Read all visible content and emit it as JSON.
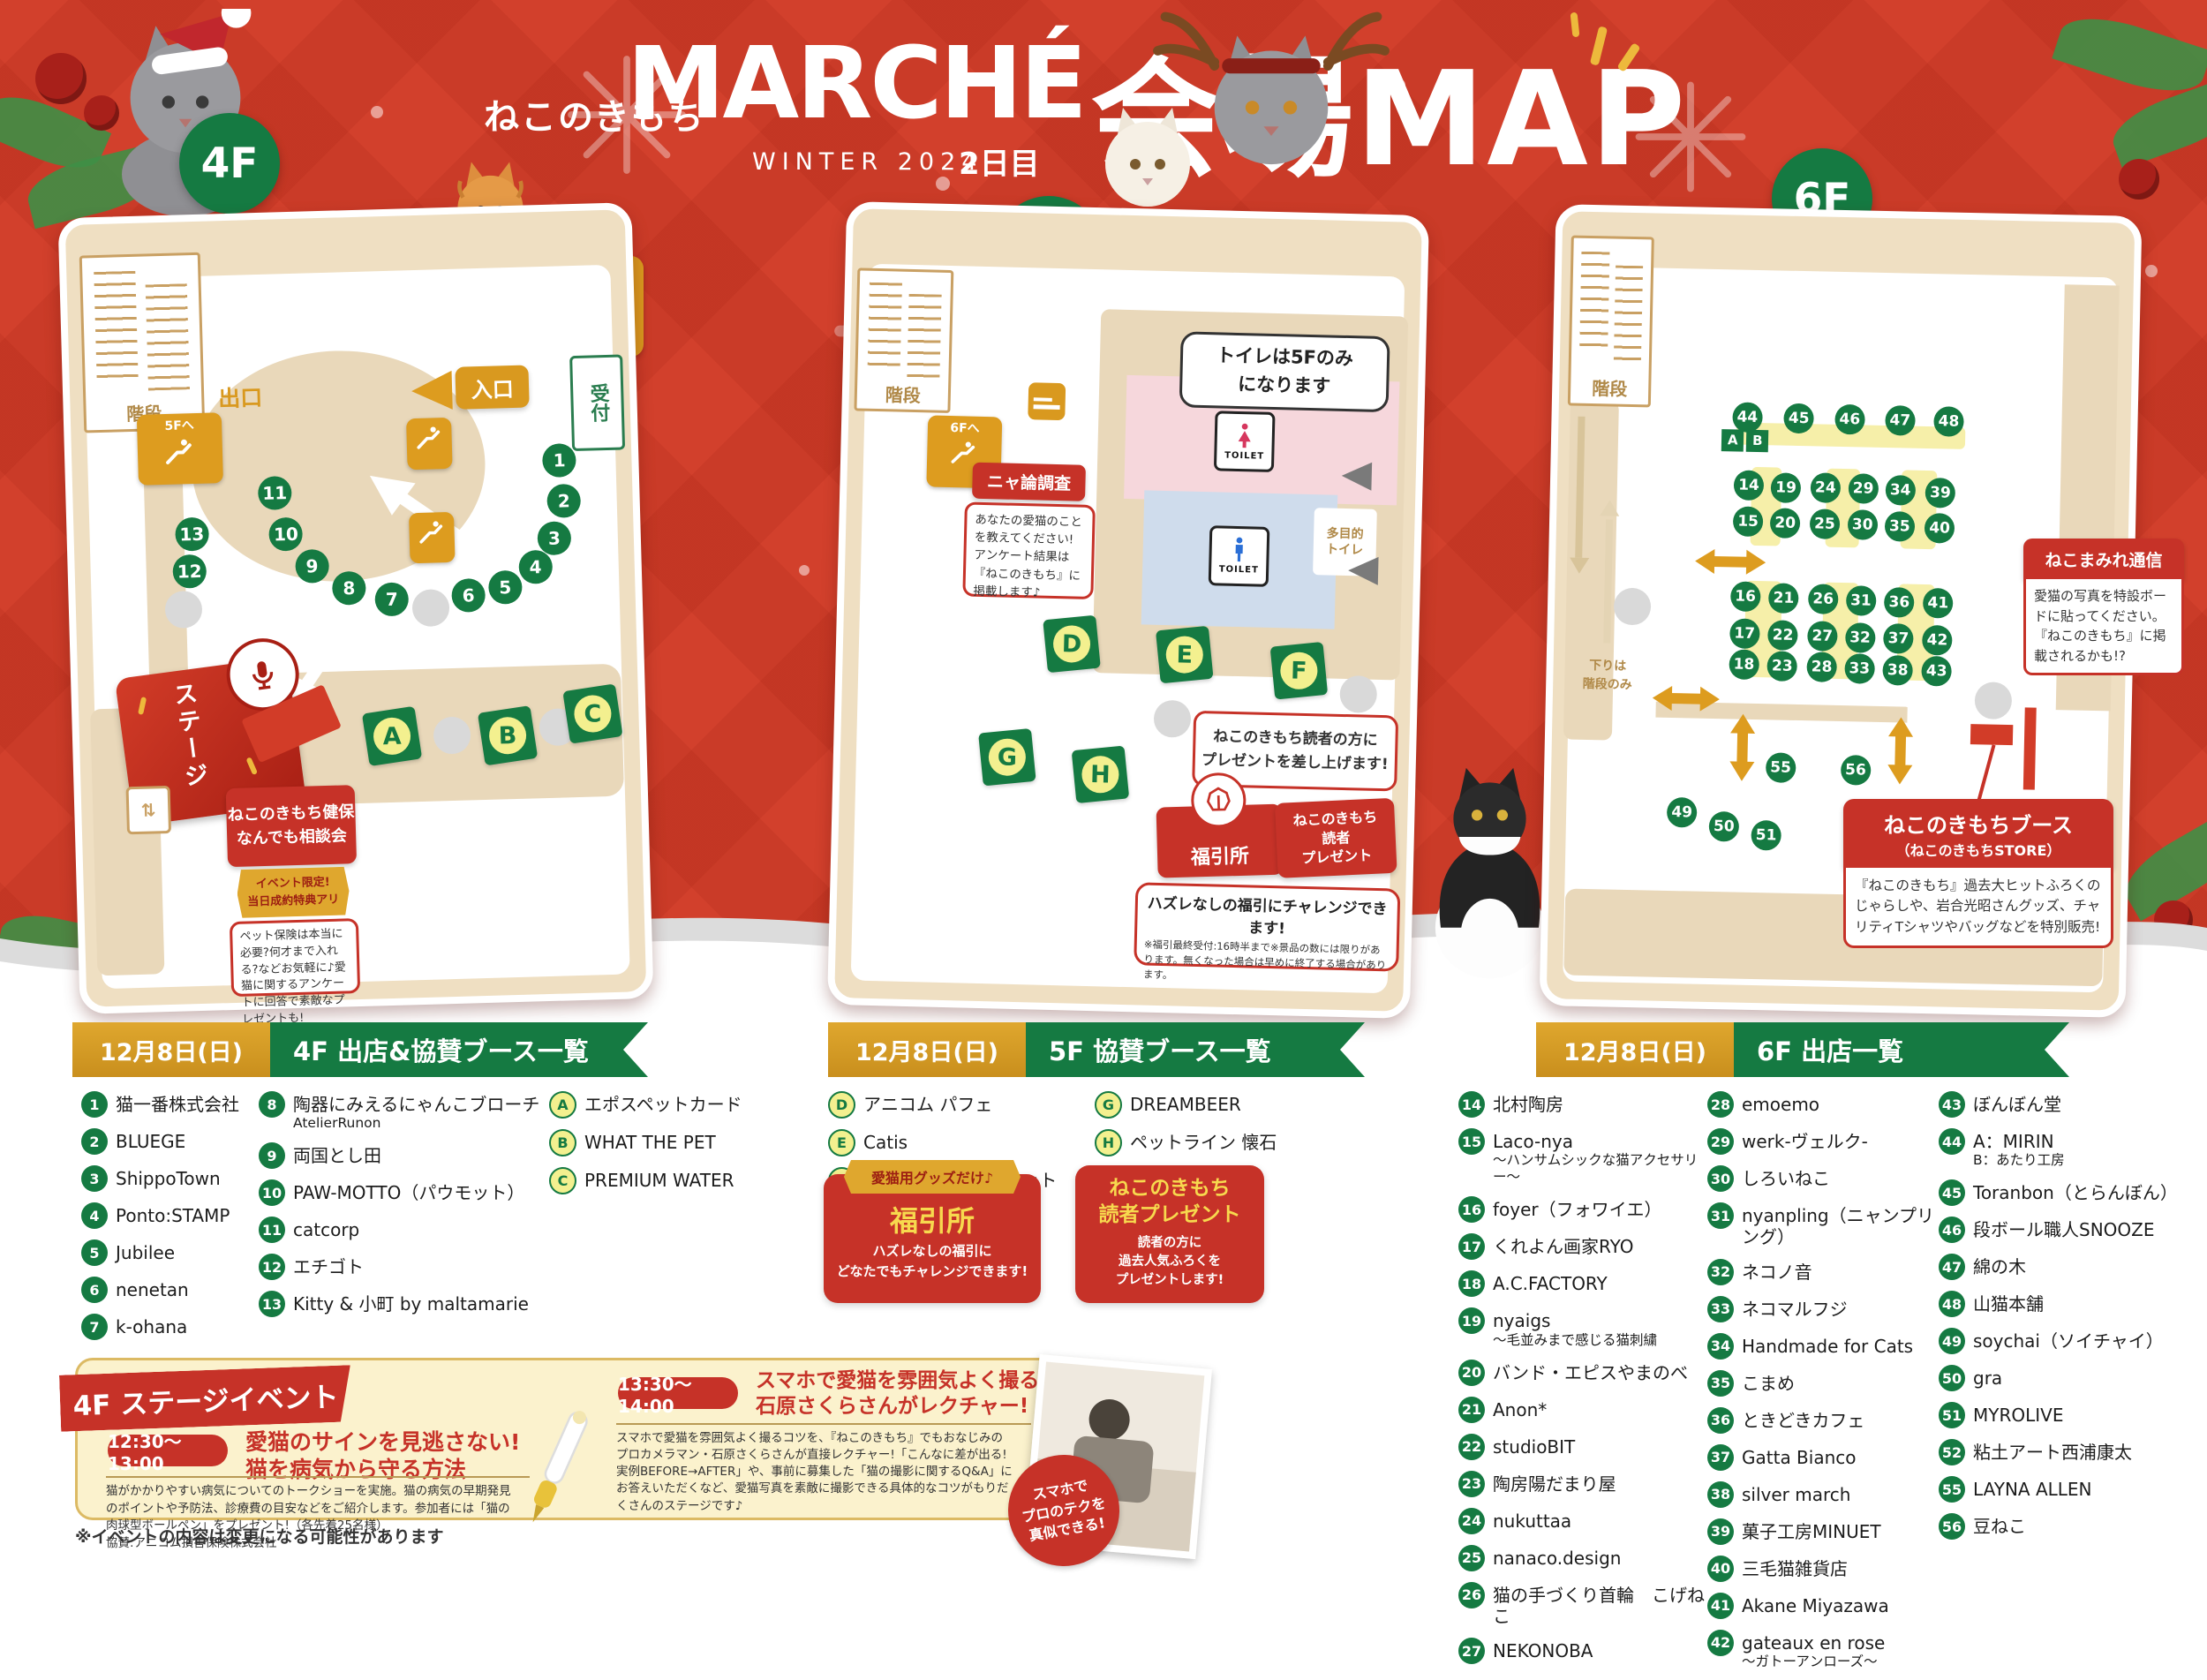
{
  "header": {
    "brand": "ねこのきもち",
    "title": "MARCHÉ",
    "season": "WINTER 2024",
    "day": "2日目",
    "map_title": "会場MAP"
  },
  "floor4": {
    "label": "4F",
    "stairs": "階段",
    "escalator": "5Fへ",
    "exit": "出口",
    "entrance": "入口",
    "reception": "受付",
    "stage": "ステージ",
    "reentry_note": "再入場の際は\nこのチラシを\nご提示ください",
    "booths": [
      {
        "n": "1",
        "x": 87.1,
        "y": 31.8
      },
      {
        "n": "2",
        "x": 87.7,
        "y": 37.0
      },
      {
        "n": "3",
        "x": 85.8,
        "y": 41.8
      },
      {
        "n": "4",
        "x": 82.3,
        "y": 45.4
      },
      {
        "n": "5",
        "x": 76.8,
        "y": 47.9
      },
      {
        "n": "6",
        "x": 70.2,
        "y": 48.8
      },
      {
        "n": "7",
        "x": 56.5,
        "y": 49.0
      },
      {
        "n": "8",
        "x": 48.9,
        "y": 47.4
      },
      {
        "n": "9",
        "x": 42.4,
        "y": 44.5
      },
      {
        "n": "10",
        "x": 37.9,
        "y": 40.3
      },
      {
        "n": "11",
        "x": 36.1,
        "y": 35.0
      },
      {
        "n": "12",
        "x": 20.5,
        "y": 44.7
      },
      {
        "n": "13",
        "x": 21.1,
        "y": 40.0
      }
    ],
    "letter_booths": [
      {
        "l": "A",
        "x": 55.8,
        "y": 66.5
      },
      {
        "l": "B",
        "x": 76.5,
        "y": 66.8
      },
      {
        "l": "C",
        "x": 91.8,
        "y": 64.3
      }
    ],
    "consult": {
      "title": "ねこのきもち健保\nなんでも相談会",
      "badge": "イベント限定!\n当日成約特典アリ",
      "body": "ペット保険は本当に必要?何才まで入れる?などお気軽に♪愛猫に関するアンケートに回答で素敵なプレゼントも!"
    }
  },
  "floor5": {
    "label": "5F",
    "stairs": "階段",
    "escalator": "6Fへ",
    "toilet": "TOILET",
    "toilet_note": "トイレは5Fのみ\nになります",
    "multi_toilet": "多目的\nトイレ",
    "survey_title": "ニャ論調査",
    "survey_body": "あなたの愛猫のことを教えてください!アンケート結果は『ねこのきもち』に掲載します♪",
    "booths": [
      {
        "l": "D",
        "x": 40.2,
        "y": 54.5
      },
      {
        "l": "E",
        "x": 60.1,
        "y": 55.5
      },
      {
        "l": "F",
        "x": 80.3,
        "y": 57.2
      },
      {
        "l": "G",
        "x": 29.3,
        "y": 69.0
      },
      {
        "l": "H",
        "x": 45.8,
        "y": 70.9
      }
    ],
    "present_note": "ねこのきもち読者の方に\nプレゼントを差し上げます!",
    "fukubiki": "福引所",
    "reader_present": "ねこのきもち\n読者\nプレゼント",
    "fukubiki_note_title": "ハズレなしの福引にチャレンジできます!",
    "fukubiki_note_body": "※福引最終受付:16時半まで※景品の数には限りがあります。無くなった場合は早めに終了する場合があります。"
  },
  "floor6": {
    "label": "6F",
    "stairs": "階段",
    "stairs_note": "下りは\n階段のみ",
    "marker_a": "A",
    "marker_b": "B",
    "booths": [
      {
        "n": "44",
        "x": 33.0,
        "y": 25.7
      },
      {
        "n": "45",
        "x": 42.0,
        "y": 25.7
      },
      {
        "n": "46",
        "x": 50.9,
        "y": 25.7
      },
      {
        "n": "47",
        "x": 59.7,
        "y": 25.7
      },
      {
        "n": "48",
        "x": 68.2,
        "y": 25.7
      },
      {
        "n": "14",
        "x": 33.5,
        "y": 34.3
      },
      {
        "n": "19",
        "x": 40.0,
        "y": 34.5
      },
      {
        "n": "24",
        "x": 46.9,
        "y": 34.4
      },
      {
        "n": "29",
        "x": 53.5,
        "y": 34.4
      },
      {
        "n": "34",
        "x": 60.0,
        "y": 34.5
      },
      {
        "n": "39",
        "x": 67.0,
        "y": 34.8
      },
      {
        "n": "15",
        "x": 33.5,
        "y": 38.9
      },
      {
        "n": "20",
        "x": 40.0,
        "y": 39.0
      },
      {
        "n": "25",
        "x": 46.9,
        "y": 39.0
      },
      {
        "n": "30",
        "x": 53.5,
        "y": 39.0
      },
      {
        "n": "35",
        "x": 60.0,
        "y": 39.1
      },
      {
        "n": "40",
        "x": 67.0,
        "y": 39.2
      },
      {
        "n": "16",
        "x": 33.3,
        "y": 48.4
      },
      {
        "n": "21",
        "x": 40.0,
        "y": 48.5
      },
      {
        "n": "26",
        "x": 46.9,
        "y": 48.5
      },
      {
        "n": "31",
        "x": 53.5,
        "y": 48.7
      },
      {
        "n": "36",
        "x": 60.2,
        "y": 48.8
      },
      {
        "n": "41",
        "x": 67.0,
        "y": 48.8
      },
      {
        "n": "17",
        "x": 33.3,
        "y": 53.1
      },
      {
        "n": "22",
        "x": 40.0,
        "y": 53.3
      },
      {
        "n": "27",
        "x": 46.9,
        "y": 53.3
      },
      {
        "n": "32",
        "x": 53.5,
        "y": 53.4
      },
      {
        "n": "37",
        "x": 60.2,
        "y": 53.4
      },
      {
        "n": "42",
        "x": 67.0,
        "y": 53.5
      },
      {
        "n": "18",
        "x": 33.3,
        "y": 57.1
      },
      {
        "n": "23",
        "x": 40.0,
        "y": 57.2
      },
      {
        "n": "28",
        "x": 46.9,
        "y": 57.2
      },
      {
        "n": "33",
        "x": 53.5,
        "y": 57.3
      },
      {
        "n": "38",
        "x": 60.2,
        "y": 57.4
      },
      {
        "n": "43",
        "x": 67.0,
        "y": 57.4
      },
      {
        "n": "55",
        "x": 40.1,
        "y": 70.1
      },
      {
        "n": "56",
        "x": 53.2,
        "y": 70.2
      },
      {
        "n": "49",
        "x": 23.0,
        "y": 76.0
      },
      {
        "n": "50",
        "x": 30.4,
        "y": 77.7
      },
      {
        "n": "51",
        "x": 37.8,
        "y": 78.7
      },
      {
        "n": "52",
        "x": 58.6,
        "y": 78.7
      }
    ],
    "tsushin_title": "ねこまみれ通信",
    "tsushin_body": "愛猫の写真を特設ボードに貼ってください。『ねこのきもち』に掲載されるかも!?",
    "store_title": "ねこのきもちブース",
    "store_subtitle": "（ねこのきもちSTORE）",
    "store_body": "『ねこのきもち』過去大ヒットふろくのじゃらしや、岩合光昭さんグッズ、チャリティTシャツやバッグなどを特別販売!"
  },
  "lists": {
    "f4": {
      "date": "12月8日(日)",
      "title": "4F 出店&協賛ブース一覧",
      "col1": [
        {
          "n": "1",
          "name": "猫一番株式会社"
        },
        {
          "n": "2",
          "name": "BLUEGE"
        },
        {
          "n": "3",
          "name": "ShippoTown"
        },
        {
          "n": "4",
          "name": "Ponto:STAMP"
        },
        {
          "n": "5",
          "name": "Jubilee"
        },
        {
          "n": "6",
          "name": "nenetan"
        },
        {
          "n": "7",
          "name": "k-ohana"
        }
      ],
      "col2": [
        {
          "n": "8",
          "name": "陶器にみえるにゃんこブローチ",
          "sub": "AtelierRunon"
        },
        {
          "n": "9",
          "name": "両国とし田"
        },
        {
          "n": "10",
          "name": "PAW-MOTTO（パウモット）"
        },
        {
          "n": "11",
          "name": "catcorp"
        },
        {
          "n": "12",
          "name": "エチゴト"
        },
        {
          "n": "13",
          "name": "Kitty & 小町 by maltamarie"
        }
      ],
      "col3": [
        {
          "n": "A",
          "name": "エポスペットカード"
        },
        {
          "n": "B",
          "name": "WHAT THE PET"
        },
        {
          "n": "C",
          "name": "PREMIUM WATER"
        }
      ]
    },
    "f5": {
      "date": "12月8日(日)",
      "title": "5F 協賛ブース一覧",
      "col1": [
        {
          "n": "D",
          "name": "アニコム パフェ"
        },
        {
          "n": "E",
          "name": "Catis"
        },
        {
          "n": "F",
          "name": "サイエンス・ダイエット"
        }
      ],
      "col2": [
        {
          "n": "G",
          "name": "DREAMBEER"
        },
        {
          "n": "H",
          "name": "ペットライン 懐石"
        }
      ],
      "fukubiki": {
        "ribbon": "愛猫用グッズだけ♪",
        "title": "福引所",
        "body": "ハズレなしの福引に\nどなたでもチャレンジできます!"
      },
      "present": {
        "title": "ねこのきもち\n読者プレゼント",
        "body": "読者の方に\n過去人気ふろくを\nプレゼントします!"
      }
    },
    "f6": {
      "date": "12月8日(日)",
      "title": "6F 出店一覧",
      "col1": [
        {
          "n": "14",
          "name": "北村陶房"
        },
        {
          "n": "15",
          "name": "Laco-nya",
          "sub": "～ハンサムシックな猫アクセサリー～"
        },
        {
          "n": "16",
          "name": "foyer（フォワイエ）"
        },
        {
          "n": "17",
          "name": "くれよん画家RYO"
        },
        {
          "n": "18",
          "name": "A.C.FACTORY"
        },
        {
          "n": "19",
          "name": "nyaigs",
          "sub": "～毛並みまで感じる猫刺繍"
        },
        {
          "n": "20",
          "name": "バンド・エピスやまのべ"
        },
        {
          "n": "21",
          "name": "Anon*"
        },
        {
          "n": "22",
          "name": "studioBIT"
        },
        {
          "n": "23",
          "name": "陶房陽だまり屋"
        },
        {
          "n": "24",
          "name": "nukuttaa"
        },
        {
          "n": "25",
          "name": "nanaco.design"
        },
        {
          "n": "26",
          "name": "猫の手づくり首輪　こげねこ"
        },
        {
          "n": "27",
          "name": "NEKONOBA"
        }
      ],
      "col2": [
        {
          "n": "28",
          "name": "emoemo"
        },
        {
          "n": "29",
          "name": "werk-ヴェルク-"
        },
        {
          "n": "30",
          "name": "しろいねこ"
        },
        {
          "n": "31",
          "name": "nyanpling（ニャンプリング）"
        },
        {
          "n": "32",
          "name": "ネコノ音"
        },
        {
          "n": "33",
          "name": "ネコマルフジ"
        },
        {
          "n": "34",
          "name": "Handmade for Cats"
        },
        {
          "n": "35",
          "name": "こまめ"
        },
        {
          "n": "36",
          "name": "ときどきカフェ"
        },
        {
          "n": "37",
          "name": "Gatta Bianco"
        },
        {
          "n": "38",
          "name": "silver march"
        },
        {
          "n": "39",
          "name": "菓子工房MINUET"
        },
        {
          "n": "40",
          "name": "三毛猫雑貨店"
        },
        {
          "n": "41",
          "name": "Akane Miyazawa"
        },
        {
          "n": "42",
          "name": "gateaux en rose",
          "sub": "～ガトーアンローズ～"
        }
      ],
      "col3": [
        {
          "n": "43",
          "name": "ぼんぼん堂"
        },
        {
          "n": "44",
          "name": "A：MIRIN",
          "sub": "B：あたり工房"
        },
        {
          "n": "45",
          "name": "Toranbon（とらんぼん）"
        },
        {
          "n": "46",
          "name": "段ボール職人SNOOZE"
        },
        {
          "n": "47",
          "name": "綿の木"
        },
        {
          "n": "48",
          "name": "山猫本舗"
        },
        {
          "n": "49",
          "name": "soychai（ソイチャイ）"
        },
        {
          "n": "50",
          "name": "gra"
        },
        {
          "n": "51",
          "name": "MYROLIVE"
        },
        {
          "n": "52",
          "name": "粘土アート西浦康太"
        },
        {
          "n": "55",
          "name": "LAYNA ALLEN"
        },
        {
          "n": "56",
          "name": "豆ねこ"
        }
      ]
    }
  },
  "stage_section": {
    "ribbon": "4F ステージイベント",
    "events": [
      {
        "time": "12:30～13:00",
        "title": "愛猫のサインを見逃さない!\n猫を病気から守る方法",
        "body": "猫がかかりやすい病気についてのトークショーを実施。猫の病気の早期発見のポイントや予防法、診療費の目安などをご紹介します。参加者には「猫の肉球型ボールペン」をプレゼント!（各先着25名様）\n協賛:アニコム損害保険株式会社"
      },
      {
        "time": "13:30～14:00",
        "title": "スマホで愛猫を雰囲気よく撮るコツを\n石原さくらさんがレクチャー!",
        "body": "スマホで愛猫を雰囲気よく撮るコツを、『ねこのきもち』でもおなじみのプロカメラマン・石原さくらさんが直接レクチャー!「こんなに差が出る!実例BEFORE→AFTER」や、事前に募集した「猫の撮影に関するQ&A」にお答えいただくなど、愛猫写真を素敵に撮影できる具体的なコツがもりだくさんのステージです♪"
      }
    ],
    "photo_badge": "スマホで\nプロのテクを\n真似できる!",
    "note": "※イベントの内容は変更になる可能性があります"
  }
}
